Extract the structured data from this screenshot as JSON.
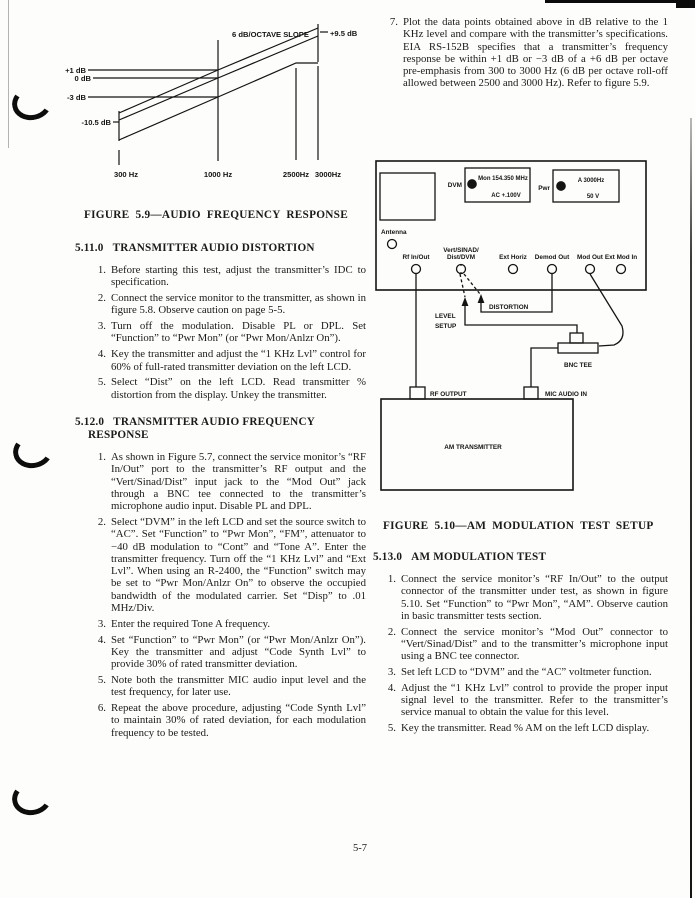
{
  "page_number": "5-7",
  "figure59": {
    "caption": "FIGURE 5.9—AUDIO FREQUENCY RESPONSE",
    "labels": {
      "slope": "6 dB/OCTAVE SLOPE",
      "p95": "+9.5 dB",
      "p1": "+1 dB",
      "zero": "0 dB",
      "m3": "-3 dB",
      "m105": "-10.5 dB",
      "x300": "300 Hz",
      "x1000": "1000 Hz",
      "x2500": "2500Hz",
      "x3000": "3000Hz"
    }
  },
  "chart_data": {
    "type": "line",
    "title": "FIGURE 5.9—AUDIO FREQUENCY RESPONSE",
    "xlabel": "Frequency (Hz)",
    "ylabel": "Response (dB relative to 1 KHz)",
    "x_scale": "log",
    "x_ticks": [
      300,
      1000,
      2500,
      3000
    ],
    "x_tick_labels": [
      "300 Hz",
      "1000 Hz",
      "2500Hz",
      "3000Hz"
    ],
    "y_reference_lines": [
      1,
      0,
      -3
    ],
    "ylim": [
      -15,
      12
    ],
    "grid": false,
    "legend": "none",
    "annotations": [
      "6 dB/OCTAVE SLOPE",
      "+9.5 dB",
      "+1 dB",
      "0 dB",
      "-3 dB",
      "-10.5 dB"
    ],
    "series": [
      {
        "name": "upper limit (+1 dB)",
        "x": [
          300,
          1000,
          3000
        ],
        "y": [
          -9.5,
          1.0,
          10.5
        ]
      },
      {
        "name": "nominal 6 dB/octave pre-emphasis",
        "x": [
          300,
          1000,
          3000
        ],
        "y": [
          -10.5,
          0.0,
          9.5
        ]
      },
      {
        "name": "lower limit (−3 dB, roll-off allowed after 2500 Hz)",
        "x": [
          300,
          1000,
          2500,
          3000
        ],
        "y": [
          -13.5,
          -3.0,
          4.9,
          4.9
        ]
      }
    ]
  },
  "sections": [
    {
      "number": "5.11.0",
      "title": "TRANSMITTER AUDIO DISTORTION",
      "items": [
        {
          "num": "1.",
          "text": "Before starting this test, adjust the transmitter’s IDC to specification."
        },
        {
          "num": "2.",
          "text": "Connect the service monitor to the transmitter, as shown in figure 5.8. Observe caution on page 5-5."
        },
        {
          "num": "3.",
          "text": "Turn off the modulation. Disable PL or DPL. Set “Function” to “Pwr Mon” (or “Pwr Mon/Anlzr On”)."
        },
        {
          "num": "4.",
          "text": "Key the transmitter and adjust the “1 KHz Lvl” control for 60% of full-rated transmitter deviation on the left LCD."
        },
        {
          "num": "5.",
          "text": "Select “Dist” on the left LCD. Read transmitter % distortion from the display. Unkey the transmitter."
        }
      ]
    },
    {
      "number": "5.12.0",
      "title": "TRANSMITTER AUDIO FREQUENCY RESPONSE",
      "items": [
        {
          "num": "1.",
          "text": "As shown in Figure 5.7, connect the service monitor’s “RF In/Out” port to the transmitter’s RF output and the “Vert/Sinad/Dist” input jack to the “Mod Out” jack through a BNC tee connected to the transmitter’s microphone audio input. Disable PL and DPL."
        },
        {
          "num": "2.",
          "text": "Select “DVM” in the left LCD and set the source switch to “AC”. Set “Function” to “Pwr Mon”, “FM”, attenuator to −40 dB modulation to “Cont” and “Tone A”. Enter the transmitter frequency. Turn off the “1 KHz Lvl” and “Ext Lvl”. When using an R-2400, the “Function” switch may be set to “Pwr Mon/Anlzr On” to observe the occupied bandwidth of the modulated carrier. Set “Disp” to .01 MHz/Div."
        },
        {
          "num": "3.",
          "text": "Enter the required Tone A frequency."
        },
        {
          "num": "4.",
          "text": "Set “Function” to “Pwr Mon” (or “Pwr Mon/Anlzr On”). Key the transmitter and adjust “Code Synth Lvl” to provide 30% of rated transmitter deviation."
        },
        {
          "num": "5.",
          "text": "Note both the transmitter MIC audio input level and the test frequency, for later use."
        },
        {
          "num": "6.",
          "text": "Repeat the above procedure, adjusting “Code Synth Lvl” to maintain 30% of rated deviation, for each modulation frequency to be tested."
        },
        {
          "num": "7.",
          "text": "Plot the data points obtained above in dB relative to the 1 KHz level and compare with the transmitter’s specifications. EIA RS-152B specifies that a transmitter’s frequency response be within +1 dB or −3 dB of a +6 dB per octave pre-emphasis from 300 to 3000 Hz (6 dB per octave roll-off allowed between 2500 and 3000 Hz). Refer to figure 5.9."
        }
      ]
    },
    {
      "number": "5.13.0",
      "title": "AM MODULATION TEST",
      "items": [
        {
          "num": "1.",
          "text": "Connect the service monitor’s “RF In/Out” to the output connector of the transmitter under test, as shown in figure 5.10. Set “Function” to “Pwr Mon”, “AM”. Observe caution in basic transmitter tests section."
        },
        {
          "num": "2.",
          "text": "Connect the service monitor’s “Mod Out” connector to “Vert/Sinad/Dist” and to the transmitter’s microphone input using a BNC tee connector."
        },
        {
          "num": "3.",
          "text": "Set left LCD to “DVM” and the “AC” voltmeter function."
        },
        {
          "num": "4.",
          "text": "Adjust the “1 KHz Lvl” control to provide the proper input signal level to the transmitter. Refer to the transmitter’s service manual to obtain the value for this level."
        },
        {
          "num": "5.",
          "text": "Key the transmitter. Read % AM on the left LCD display."
        }
      ]
    }
  ],
  "figure510": {
    "caption": "FIGURE 5.10—AM MODULATION TEST SETUP",
    "labels": {
      "dvm": "DVM",
      "dvm_line1": "Mon 154.350 MHz",
      "dvm_line2": "AC +.100V",
      "pwr": "Pwr",
      "pwr_line1": "A 3000Hz",
      "pwr_line2": "50 V",
      "antenna": "Antenna",
      "conn_rf": "Rf In/Out",
      "conn_vert_a": "Vert/SINAD/",
      "conn_vert_b": "Dist/DVM",
      "conn_ext_horiz": "Ext Horiz",
      "conn_demod": "Demod Out",
      "conn_mod": "Mod Out",
      "conn_ext_mod": "Ext Mod In",
      "level1": "LEVEL",
      "level2": "SETUP",
      "distortion": "DISTORTION",
      "bnc_tee": "BNC TEE",
      "rf_output": "RF OUTPUT",
      "mic_audio_in": "MIC AUDIO IN",
      "am_transmitter": "AM TRANSMITTER"
    }
  }
}
